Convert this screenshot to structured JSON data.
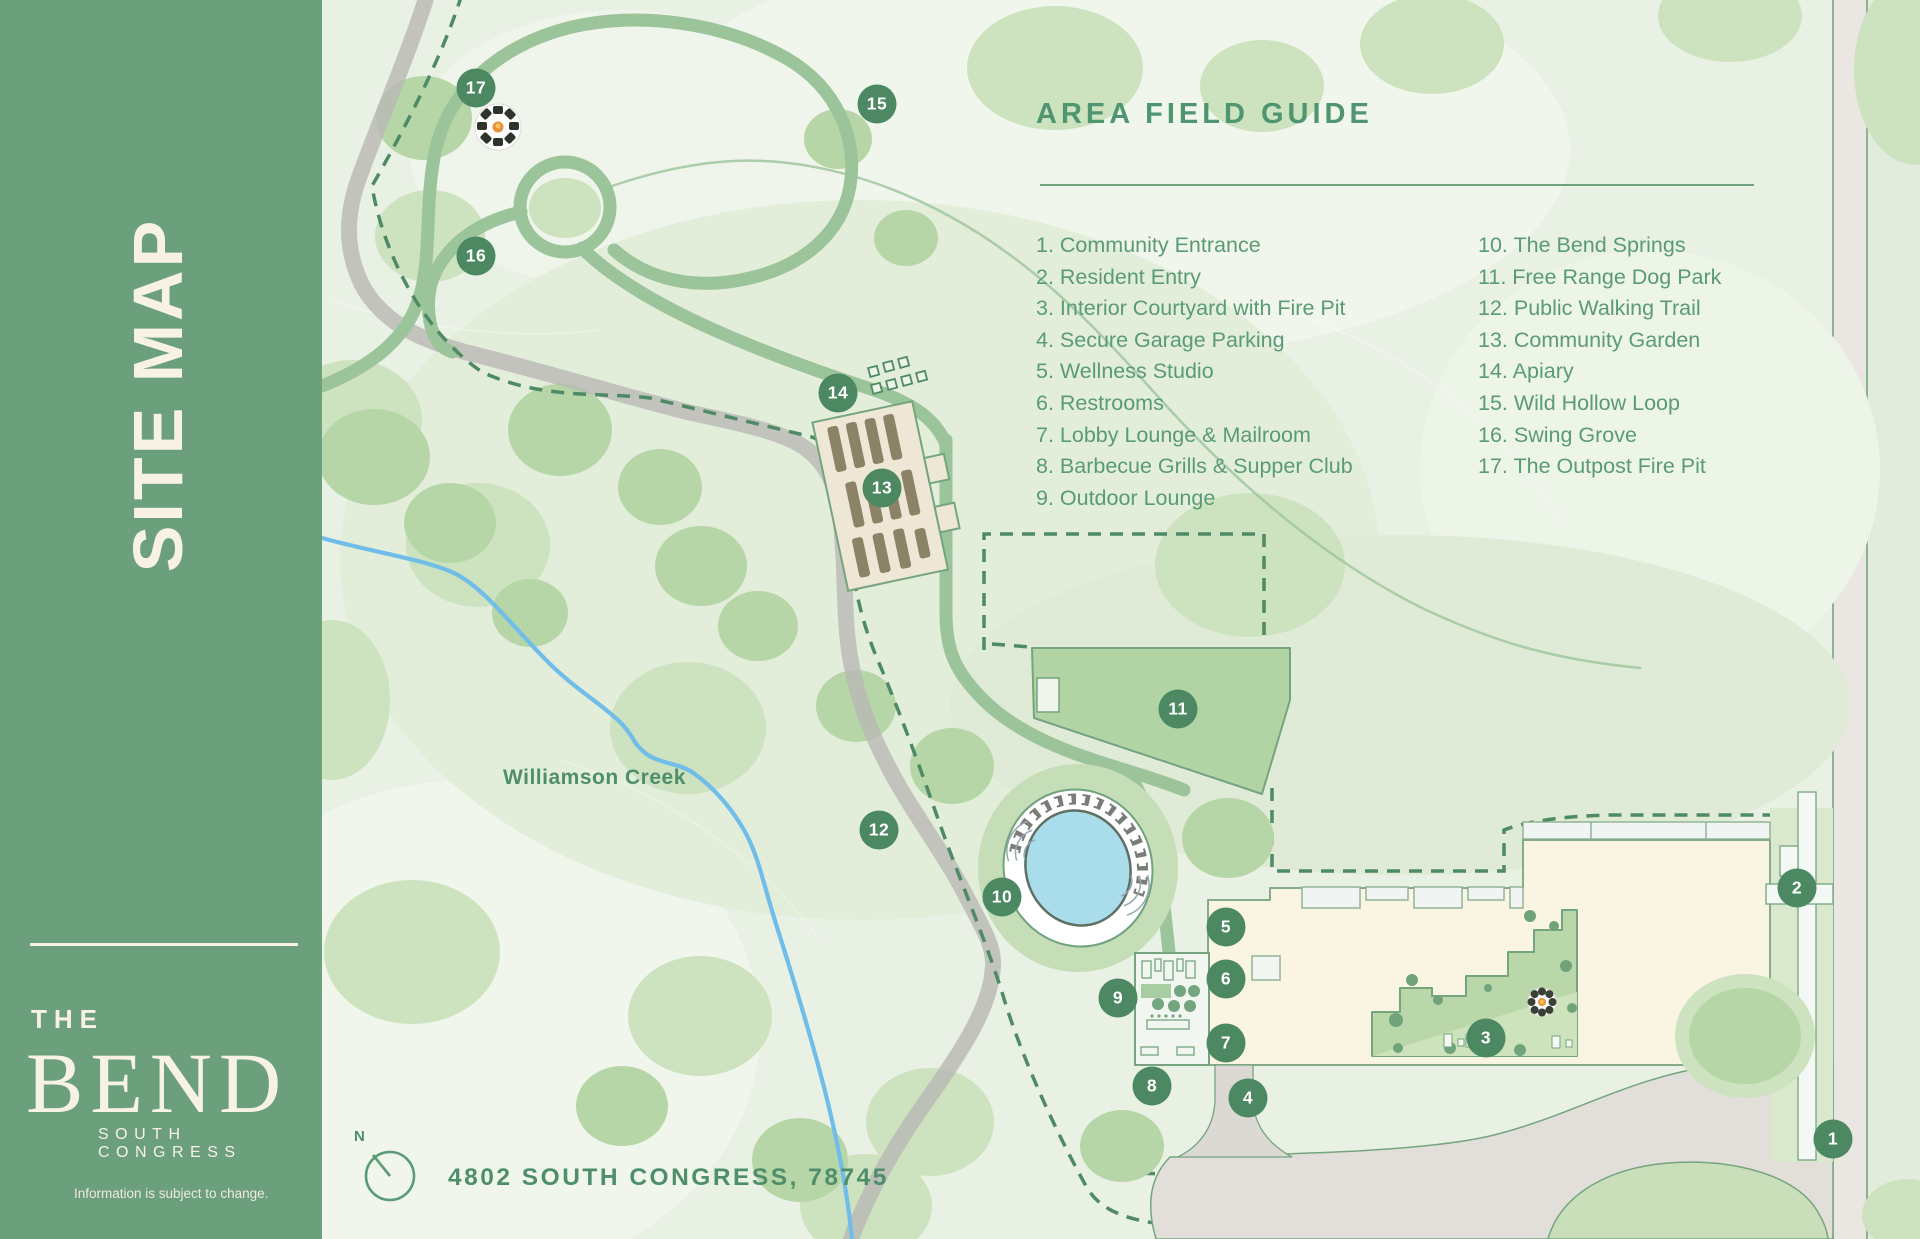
{
  "sidebar": {
    "vertical_title": "SITE MAP",
    "brand_the": "THE",
    "brand_name": "BEND",
    "brand_subtitle": "SOUTH CONGRESS",
    "disclaimer": "Information is subject to change."
  },
  "legend": {
    "title": "AREA FIELD GUIDE",
    "items": [
      "1. Community Entrance",
      "2. Resident Entry",
      "3. Interior Courtyard with Fire Pit",
      "4. Secure Garage Parking",
      "5. Wellness Studio",
      "6. Restrooms",
      "7. Lobby Lounge & Mailroom",
      "8. Barbecue Grills & Supper Club",
      "9. Outdoor Lounge",
      "10. The Bend Springs",
      "11. Free Range Dog Park",
      "12. Public Walking Trail",
      "13. Community Garden",
      "14. Apiary",
      "15. Wild Hollow Loop",
      "16. Swing Grove",
      "17. The Outpost Fire Pit"
    ]
  },
  "map": {
    "creek_label": "Williamson Creek",
    "compass_label": "N",
    "address": "4802 SOUTH CONGRESS, 78745",
    "markers": [
      {
        "n": "1",
        "x": 1833,
        "y": 1139
      },
      {
        "n": "2",
        "x": 1797,
        "y": 888
      },
      {
        "n": "3",
        "x": 1486,
        "y": 1038
      },
      {
        "n": "4",
        "x": 1248,
        "y": 1098
      },
      {
        "n": "5",
        "x": 1226,
        "y": 927
      },
      {
        "n": "6",
        "x": 1226,
        "y": 979
      },
      {
        "n": "7",
        "x": 1226,
        "y": 1043
      },
      {
        "n": "8",
        "x": 1152,
        "y": 1086
      },
      {
        "n": "9",
        "x": 1118,
        "y": 998
      },
      {
        "n": "10",
        "x": 1002,
        "y": 897
      },
      {
        "n": "11",
        "x": 1178,
        "y": 709
      },
      {
        "n": "12",
        "x": 879,
        "y": 830
      },
      {
        "n": "13",
        "x": 882,
        "y": 488
      },
      {
        "n": "14",
        "x": 838,
        "y": 393
      },
      {
        "n": "15",
        "x": 877,
        "y": 104
      },
      {
        "n": "16",
        "x": 476,
        "y": 256
      },
      {
        "n": "17",
        "x": 476,
        "y": 88
      }
    ]
  },
  "colors": {
    "sidebar_green": "#6CA07C",
    "legend_green": "#579A74",
    "marker_green": "#4C8862",
    "cream": "#F7F2E4",
    "building_cream": "#FAF4E3",
    "pool_blue": "#A9DDEB",
    "creek_blue": "#6FBDE8",
    "trail_gray": "#B9B8B4"
  }
}
